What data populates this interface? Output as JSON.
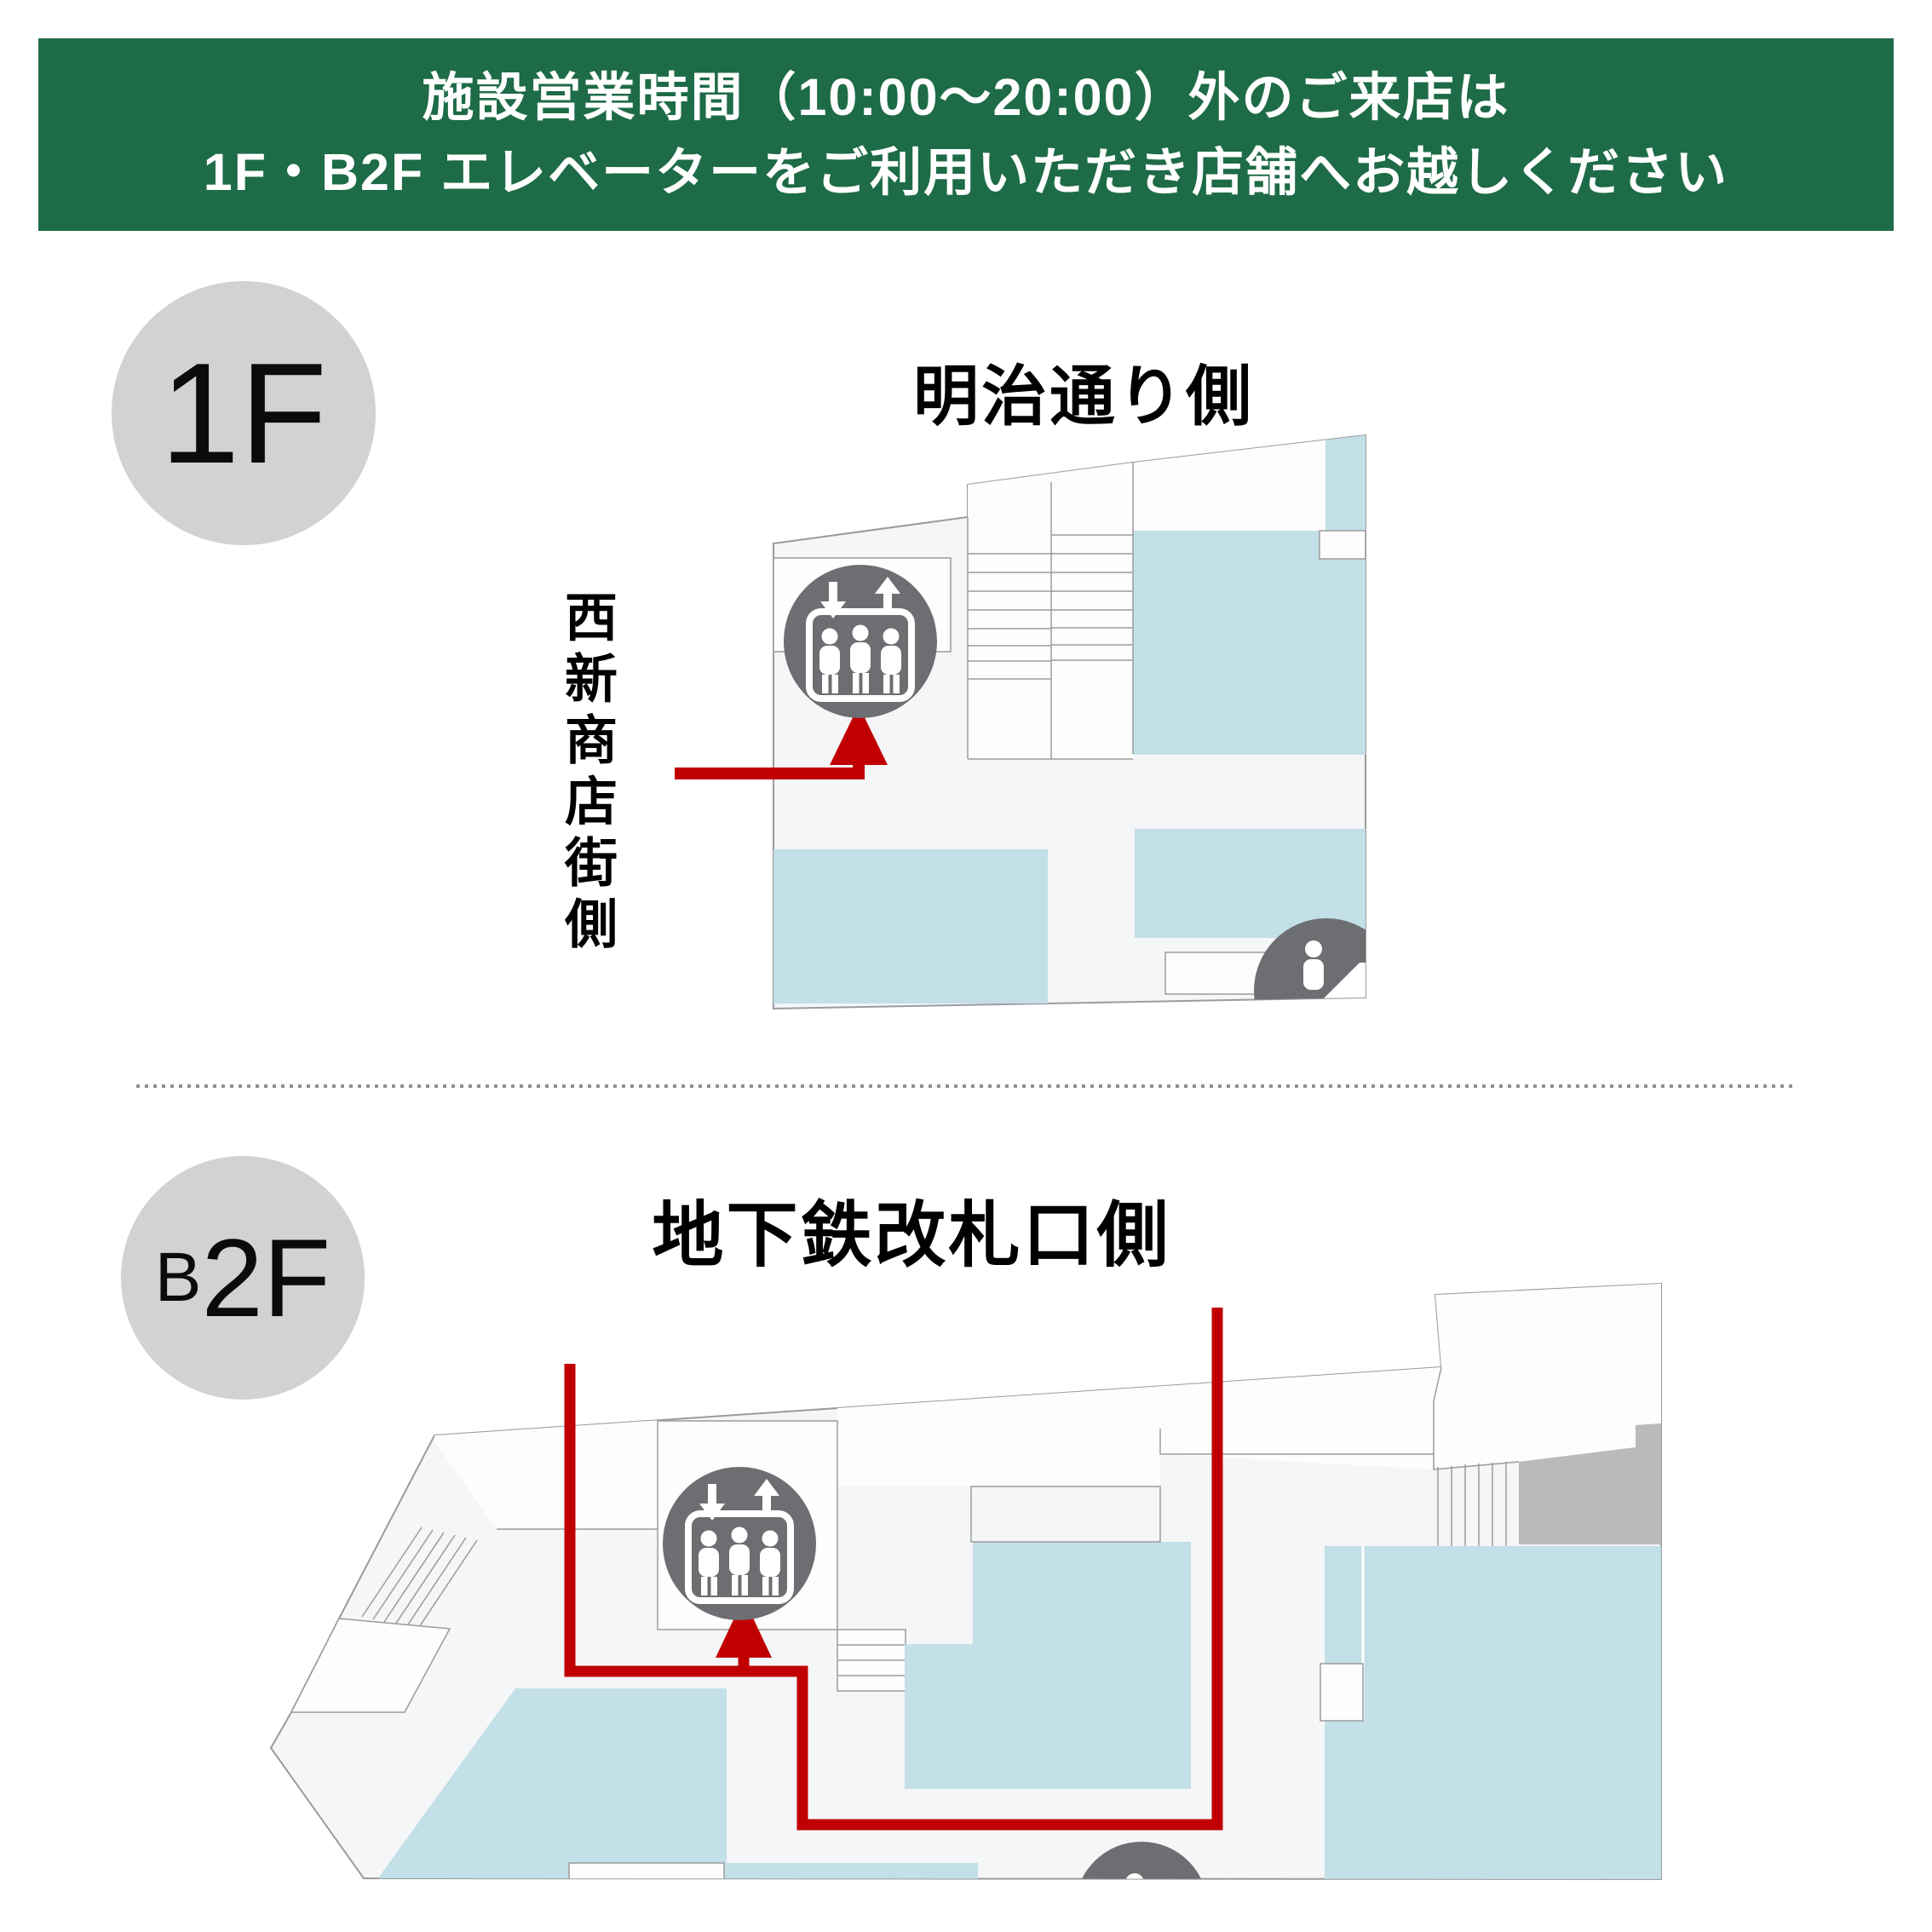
{
  "banner": {
    "line1": "施設営業時間（10:00～20:00）外のご来店は",
    "line2": "1F・B2F エレベーターをご利用いただき店舗へお越しください"
  },
  "floor_1f": {
    "badge": "1F",
    "area_title": "明治通り側",
    "side_label": "西新商店街側"
  },
  "floor_b2f": {
    "badge_small": "B",
    "badge_large": "2F",
    "area_title": "地下鉄改札口側"
  },
  "icons": {
    "elevator": "elevator-icon",
    "escalator": "escalator-icon"
  },
  "colors": {
    "banner_green": "#1e6b47",
    "route_red": "#c00000",
    "shop_blue": "#c3dfe8",
    "icon_gray": "#6d6e71",
    "block_gray": "#b9babc",
    "badge_gray": "#d2d2d4",
    "floor_fill": "#f5f6f7",
    "room_white": "#fdfdfe",
    "outline_gray": "#9b9b9b"
  }
}
